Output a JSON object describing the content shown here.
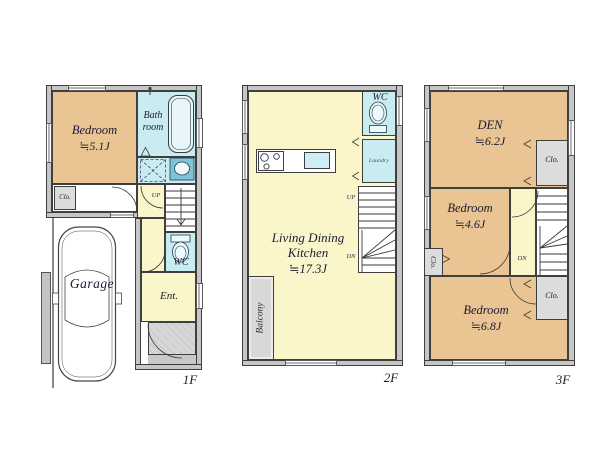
{
  "floor1": {
    "floor_label": "1F",
    "bedroom_name": "Bedroom",
    "bedroom_size": "≒5.1J",
    "bath_line1": "Bath",
    "bath_line2": "room",
    "closet": "Clo.",
    "up": "UP",
    "wc": "WC",
    "entrance": "Ent.",
    "garage": "Garage"
  },
  "floor2": {
    "floor_label": "2F",
    "wc": "WC",
    "laundry": "Laundry",
    "up": "UP",
    "dn": "DN",
    "ldk_line1": "Living Dining",
    "ldk_line2": "Kitchen",
    "ldk_size": "≒17.3J",
    "balcony": "Balcony"
  },
  "floor3": {
    "floor_label": "3F",
    "den_name": "DEN",
    "den_size": "≒6.2J",
    "closet_top": "Clo.",
    "closet_left": "Clo.",
    "closet_bottom": "Clo.",
    "bedroom1_name": "Bedroom",
    "bedroom1_size": "≒4.6J",
    "bedroom2_name": "Bedroom",
    "bedroom2_size": "≒6.8J",
    "dn": "DN"
  },
  "colors": {
    "room_tan": "#eac492",
    "hall_yellow": "#faf6c9",
    "water_cyan": "#c9ecf1",
    "closet_gray": "#dcdcdc",
    "wall_gray": "#c6c6c6",
    "porch_gray": "#d1d1d1",
    "line_dark": "#3f3f3f",
    "text_dark": "#1b1b33",
    "nav_blue": "#2d2d70"
  }
}
